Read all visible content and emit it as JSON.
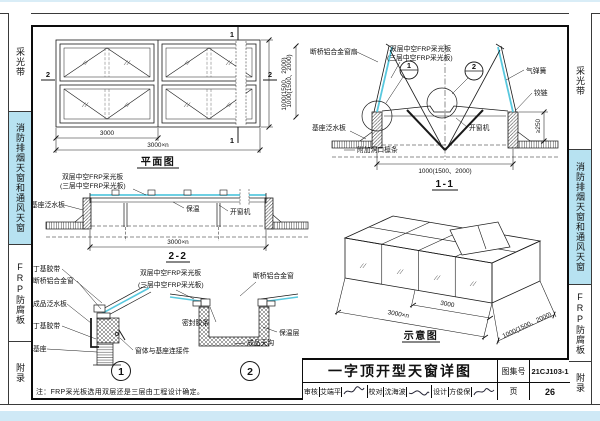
{
  "sidebar": {
    "items": [
      {
        "label": "采光带",
        "active": false
      },
      {
        "label": "消防排烟天窗和通风天窗",
        "active": true
      },
      {
        "label": "FRP防腐板",
        "active": false
      },
      {
        "label": "附录",
        "active": false
      }
    ],
    "active_color": "#b7e2f1"
  },
  "plan": {
    "caption": "平面图",
    "dim_bay": "3000",
    "dim_total": "3000×n",
    "dim_height": "1000(1500、2000)",
    "mark_section_2": "2",
    "mark_section_1": "1"
  },
  "s11": {
    "caption": "1-1",
    "lbl_sash": "断桥铝合金窗扇",
    "lbl_panel2": "双层中空FRP采光板",
    "lbl_panel3": "(三层中空FRP采光板)",
    "lbl_gas": "气弹簧",
    "lbl_hinge": "铰链",
    "lbl_opener": "开窗机",
    "lbl_flash": "基座泛水板",
    "lbl_purlin": "附加洞口檩条",
    "dim_h": "1000(1500、2000)",
    "dim_w": "1000(1500、2000)",
    "dim_curb": "≥250",
    "d1": "1",
    "d2": "2"
  },
  "s22": {
    "caption": "2-2",
    "lbl_panel2": "双层中空FRP采光板",
    "lbl_panel3": "(三层中空FRP采光板)",
    "lbl_flash": "基座泛水板",
    "lbl_ins": "保温",
    "lbl_opener": "开窗机",
    "dim_total": "3000×n"
  },
  "d1": {
    "num": "1",
    "lbl_butyl_top": "丁基胶带",
    "lbl_window": "断桥铝合金窗",
    "lbl_flash": "成品泛水板",
    "lbl_butyl_bot": "丁基胶带",
    "lbl_base": "基座",
    "lbl_conn": "窗体与基座连接件"
  },
  "d2": {
    "num": "2",
    "lbl_panel2": "双层中空FRP采光板",
    "lbl_panel3": "(三层中空FRP采光板)",
    "lbl_window": "断桥铝合金窗",
    "lbl_seal": "密封胶条",
    "lbl_ins": "保温层",
    "lbl_gutter": "成品天沟"
  },
  "schematic": {
    "caption": "示意图",
    "dim_total": "3000×n",
    "dim_bay": "3000",
    "dim_width": "1000(1500、2000)"
  },
  "note": "注：FRP采光板选用双层还是三层由工程设计确定。",
  "titleblock": {
    "title": "一字顶开型天窗详图",
    "atlas_label": "图集号",
    "atlas_no": "21CJ103-1",
    "page_label": "页",
    "page_no": "26",
    "roles": [
      {
        "label": "审核",
        "name": "艾端平"
      },
      {
        "label": "校对",
        "name": "沈海波"
      },
      {
        "label": "设计",
        "name": "方俊保"
      }
    ]
  }
}
